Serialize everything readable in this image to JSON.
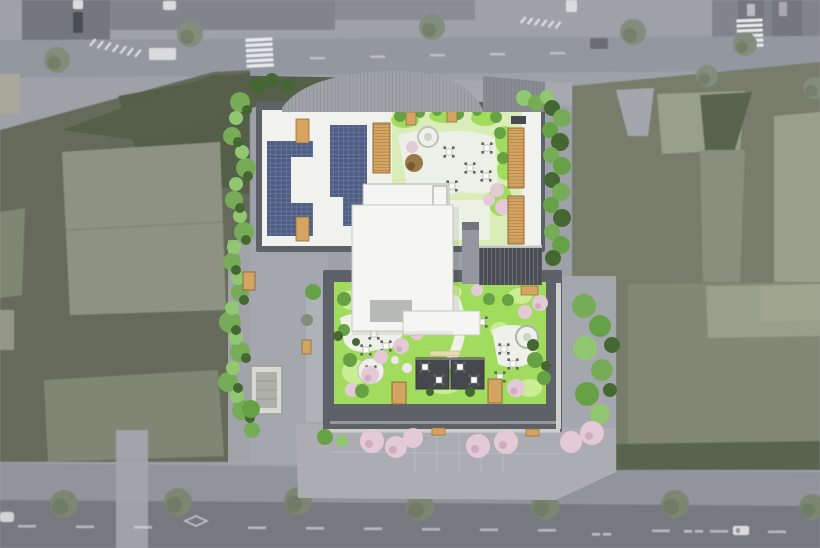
{
  "scene": {
    "label": "aerial-rooftop-site-plan-render",
    "solar_arrays": 2,
    "roof_gardens": 2,
    "pergolas": 2,
    "rooftop_skylights": 2,
    "louver_screens": 3,
    "crosswalks": 2,
    "street_trees_top_road": 7,
    "street_trees_bottom_road": 7,
    "flowering_street_trees": 7,
    "vehicles": 6,
    "stairwells": 1
  },
  "palette": {
    "base_pavement": "#999ca4",
    "road_top": "#8e929b",
    "road_bottom": "#6f727a",
    "sidewalk_bottom": "#8c8f97",
    "building_dark": "#6d7077",
    "building_mid": "#7b7e86",
    "marking_white": "#e8e9ec",
    "tree_muted": "#7c8774",
    "tree_muted_dark": "#5c6652",
    "tree_bottom": "#74806a",
    "parcel_left": "#5d6452",
    "parcel_roof_light": "#888d7d",
    "parcel_roof_mid": "#79806d",
    "parcel_green_dark": "#4c5741",
    "parcel_right": "#6f7663",
    "parcel_right_light": "#939a84",
    "parcel_right_dark": "#515c45",
    "driveway": "#9fa2a8",
    "site_ground": "#a2a4ab",
    "plaza": "#a7a9ae",
    "canopy": "#9b9ea3",
    "canopy_dark": "#82858c",
    "parapet": "#56595f",
    "roof_white": "#f1f2ee",
    "solar_panel": "#46567e",
    "wood": "#d2a058",
    "wood_dark": "#8d6531",
    "garden_light": "#d8edb6",
    "lawn": "#9edb56",
    "lawn_light": "#c8ec8e",
    "path_white": "#eef0e8",
    "shrub_green": "#5f9c3d",
    "shrub_dark": "#3c6028",
    "bush_bright": "#6fa84f",
    "bush_light": "#8cc46a",
    "pink_tree": "#e3c8d4",
    "pink_dark": "#c8a2b5",
    "pergola": "#3c3f43",
    "stair_dark": "#41444a",
    "stair_light": "#8f929a",
    "core_white": "#f5f6f3",
    "core_gray": "#b5b7b5",
    "white_car": "#d9dadd",
    "dark_car": "#41444a"
  }
}
